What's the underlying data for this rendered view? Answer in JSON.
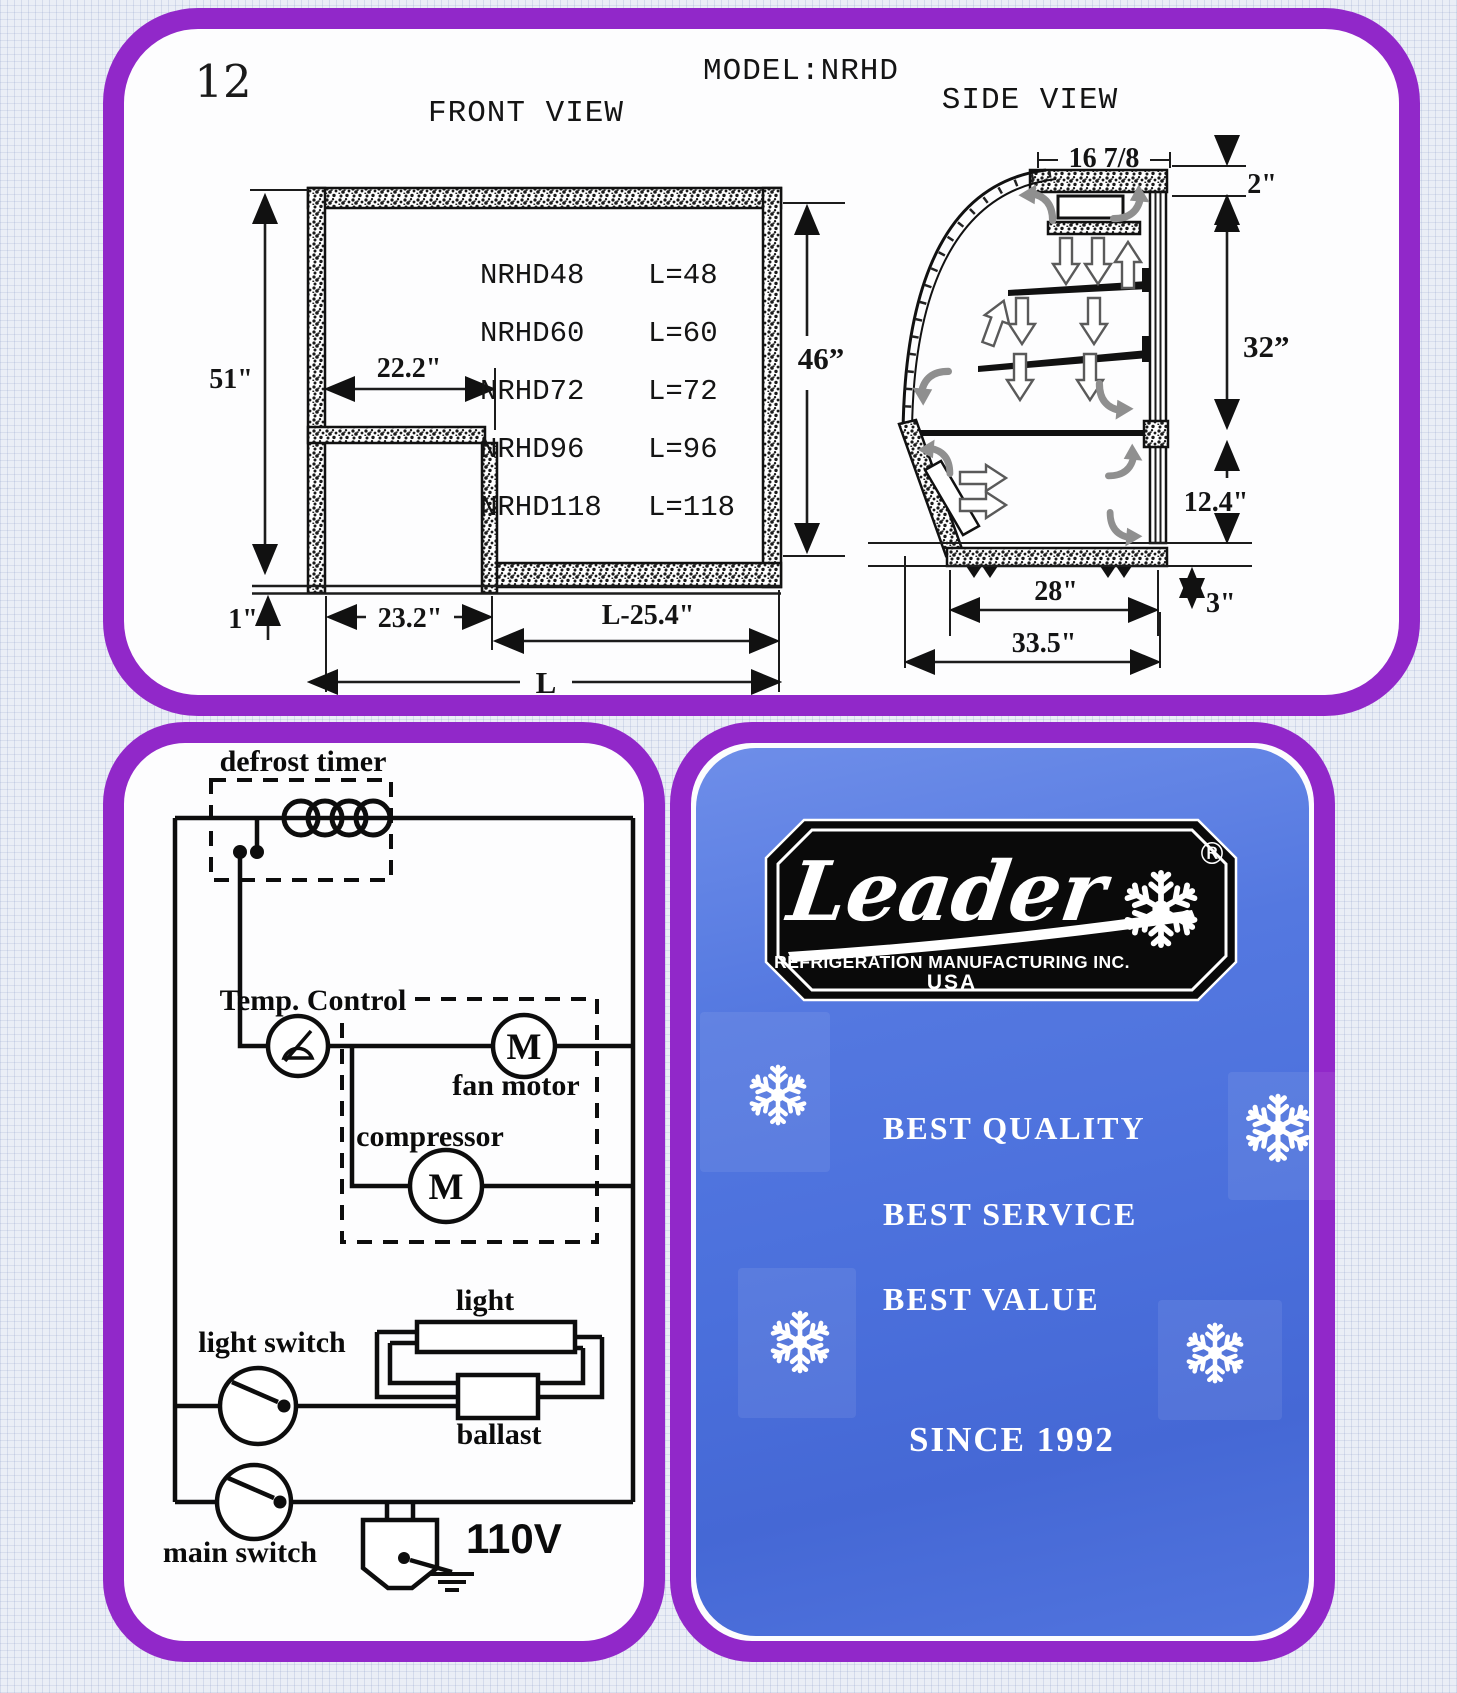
{
  "page": {
    "number": "12",
    "model": "MODEL:NRHD"
  },
  "front_view": {
    "title": "FRONT VIEW",
    "models": [
      {
        "name": "NRHD48",
        "len": "L=48"
      },
      {
        "name": "NRHD60",
        "len": "L=60"
      },
      {
        "name": "NRHD72",
        "len": "L=72"
      },
      {
        "name": "NRHD96",
        "len": "L=96"
      },
      {
        "name": "NRHD118",
        "len": "L=118"
      }
    ],
    "dims": {
      "height": "51\"",
      "width_upper": "22.2\"",
      "opening": "46”",
      "base": "1\"",
      "width_lower": "23.2\"",
      "well": "L-25.4\"",
      "length": "L"
    }
  },
  "side_view": {
    "title": "SIDE VIEW",
    "dims": {
      "top_width": "16 7/8",
      "canopy": "2\"",
      "upper_height": "32”",
      "lower_height": "12.4\"",
      "base_width": "28\"",
      "base_height": "3\"",
      "total_depth": "33.5\""
    }
  },
  "wiring": {
    "defrost": "defrost timer",
    "temp": "Temp. Control",
    "fan": "fan motor",
    "compressor": "compressor",
    "light": "light",
    "light_switch": "light switch",
    "ballast": "ballast",
    "main_switch": "main switch",
    "voltage": "110V",
    "motor": "M"
  },
  "brand": {
    "name": "Leader",
    "sub": "REFRIGERATION MANUFACTURING INC.",
    "country": "USA",
    "reg": "®",
    "slogans": [
      "BEST QUALITY",
      "BEST SERVICE",
      "BEST VALUE"
    ],
    "since": "SINCE 1992"
  },
  "colors": {
    "purple": "#9128c9",
    "blue": "#4b70dc",
    "badge": "#0a0a0a"
  }
}
